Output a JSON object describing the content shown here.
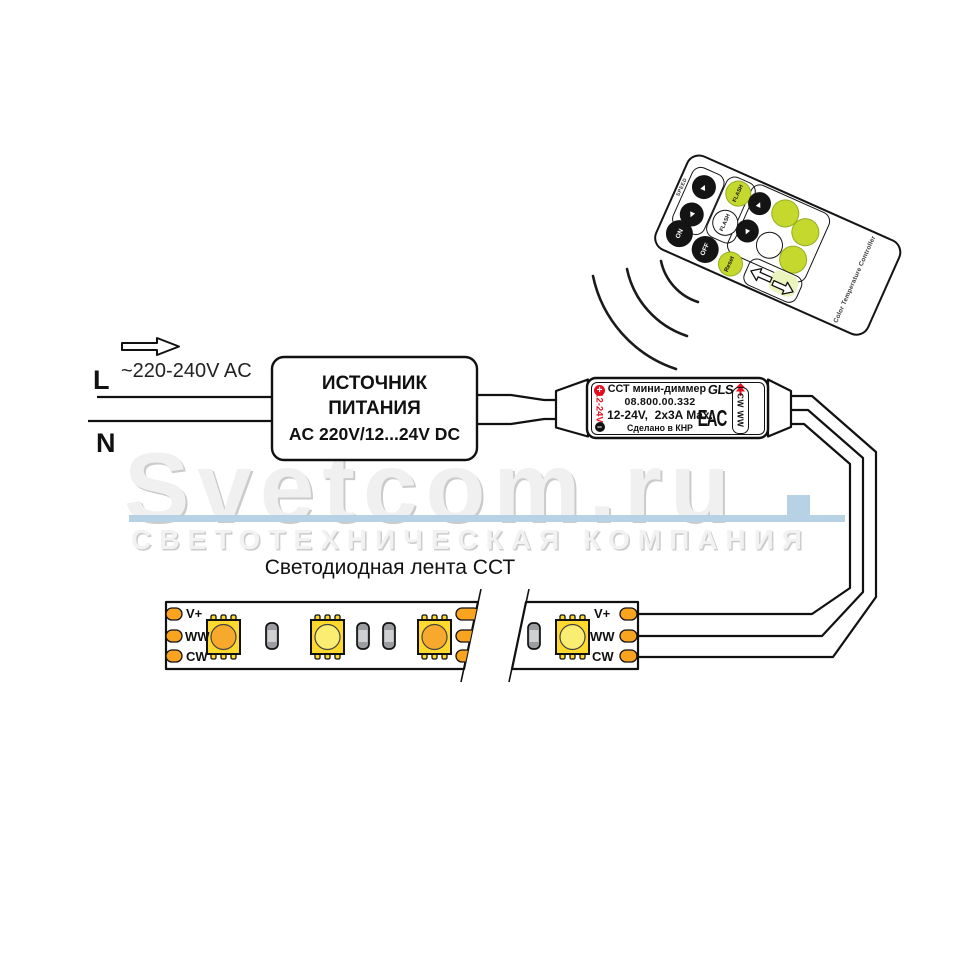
{
  "colors": {
    "accent-green": "#c4d82e",
    "green-light": "#ebf4bc",
    "pad-orange": "#f9a41f",
    "led-yellow": "#ffd92e",
    "led-warm": "#f6a92c",
    "led-cool": "#f9ee72",
    "resistor-gray": "#9b9da0",
    "resistor-light": "#cfd0d2",
    "bar-blue": "#b7d2e4",
    "label-red": "#e30f20"
  },
  "watermark": {
    "brand": "Svetcom.ru",
    "subtitle": "СВЕТОТЕХНИЧЕСКАЯ КОМПАНИЯ"
  },
  "mains": {
    "live": "L",
    "neutral": "N",
    "voltage": "~220-240V AC"
  },
  "psu": {
    "name_line1": "ИСТОЧНИК",
    "name_line2": "ПИТАНИЯ",
    "rating": "AC 220V/12...24V DC"
  },
  "dimmer": {
    "plus": "+",
    "minus": "−",
    "input_voltage": "12-24V",
    "name": "ССТ мини-диммер",
    "brand": "GLS",
    "model": "08.800.00.332",
    "rating": "12-24V,  2x3A Max.",
    "origin": "Сделано в КНР",
    "cert_mark": "EAC",
    "output_channels": "CW WW"
  },
  "strip": {
    "title": "Светодиодная лента ССТ",
    "pads": [
      "V+",
      "WW",
      "CW"
    ]
  },
  "remote": {
    "side_label": "Color Temperature Controller",
    "speed_label": "SPEED",
    "up_icon": "▲",
    "down_icon": "▼",
    "flash_label": "FLASH",
    "on_label": "ON",
    "off_label": "OFF",
    "reset_label": "Reset"
  }
}
